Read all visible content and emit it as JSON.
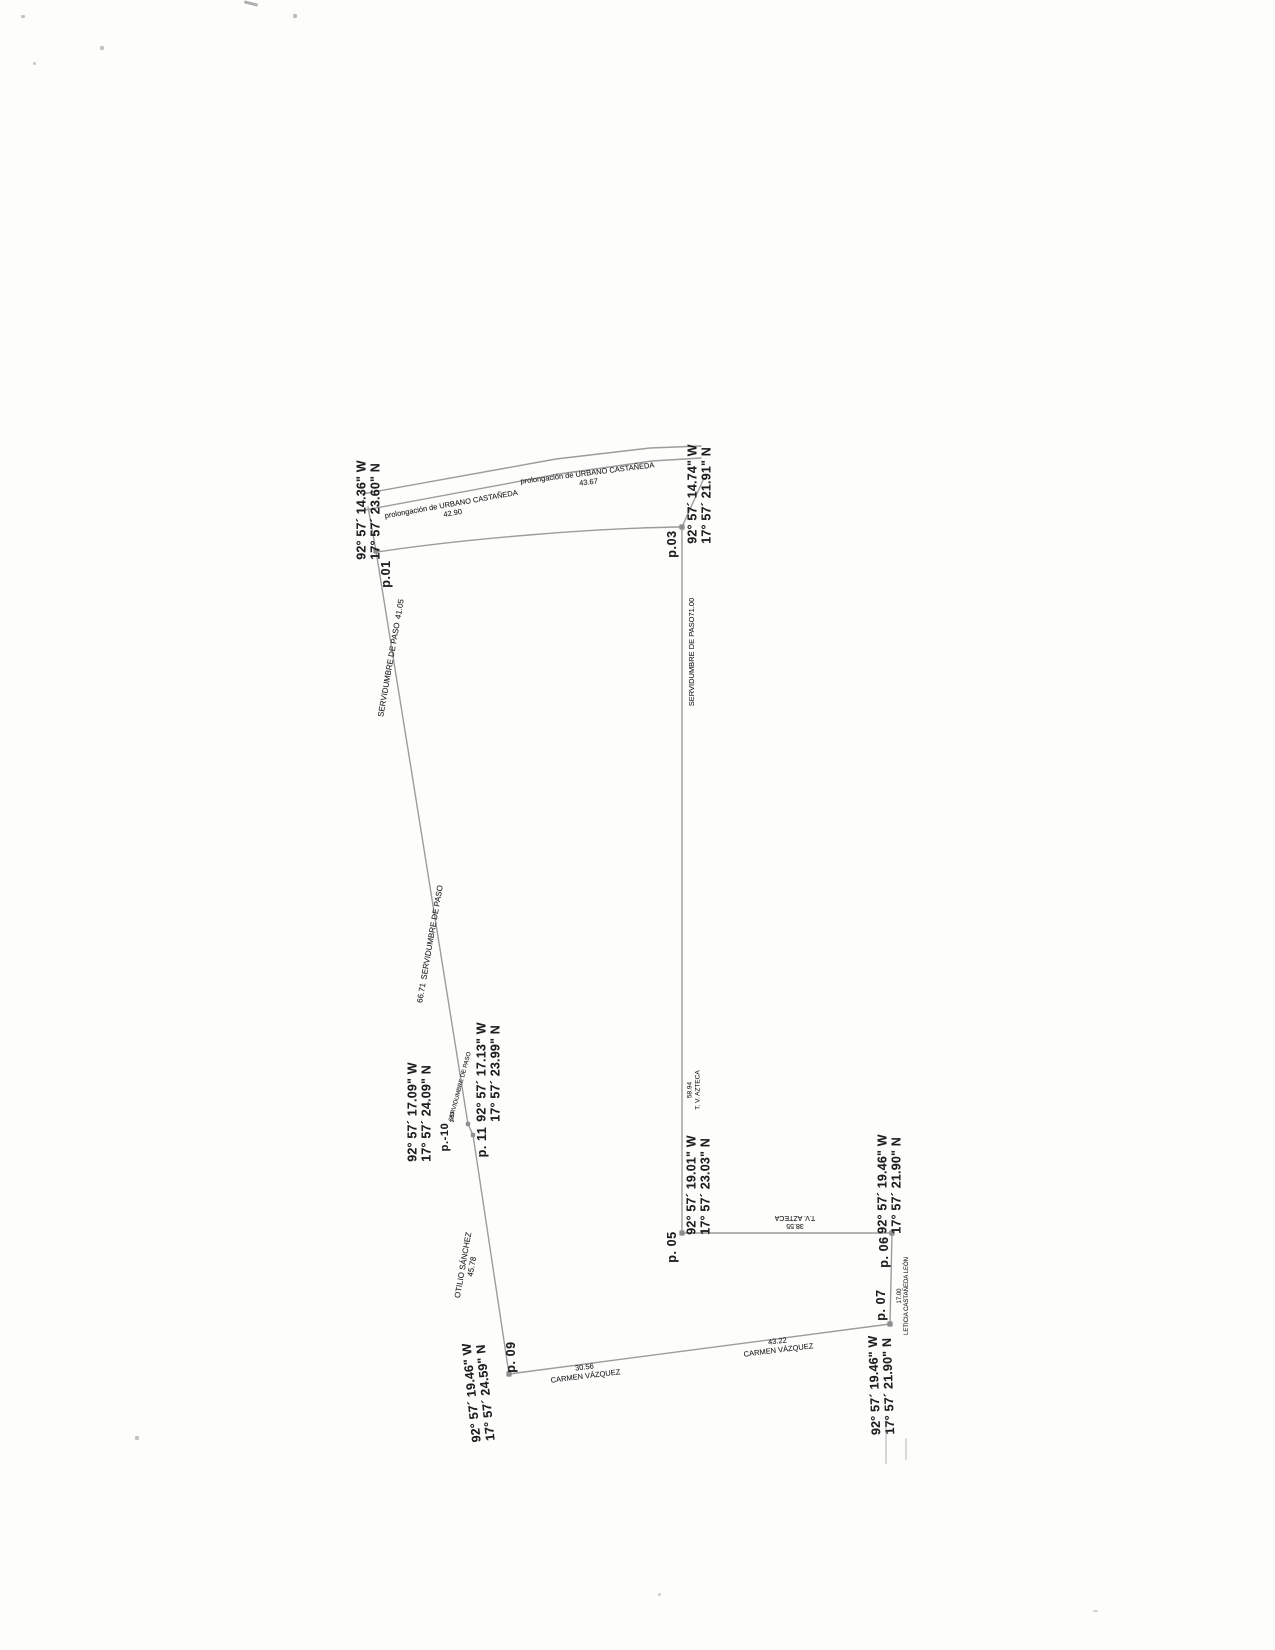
{
  "colors": {
    "paper": "#fdfdfc",
    "boundary_line": "#9c9c9c",
    "text": "#1e1e1e",
    "node": "#8e8e8e"
  },
  "points": {
    "p01": {
      "label": "p.01",
      "w": "92° 57´ 14.36\" W",
      "n": "17° 57´ 23.60\" N"
    },
    "p03": {
      "label": "p.03",
      "w": "92° 57´ 14.74\" W",
      "n": "17° 57´ 21.91\" N"
    },
    "p05": {
      "label": "p. 05",
      "w": "92° 57´ 19.01\" W",
      "n": "17° 57´ 23.03\" N"
    },
    "p06": {
      "label": "p. 06",
      "w": "92° 57´ 19.46\" W",
      "n": "17° 57´ 21.90\" N"
    },
    "p07": {
      "label": "p. 07",
      "w": "92° 57´ 19.46\" W",
      "n": "17° 57´ 21.90\" N"
    },
    "p09": {
      "label": "p. 09",
      "w": "92° 57´ 19.46\" W",
      "n": "17° 57´ 24.59\" N"
    },
    "p10": {
      "label": "p.-10",
      "w": "92° 57´ 17.09\" W",
      "n": "17° 57´ 24.09\" N"
    },
    "p11": {
      "label": "p. 11",
      "w": "92° 57´ 17.13\" W",
      "n": "17° 57´ 23.99\" N"
    }
  },
  "edges": {
    "road_left": {
      "name": "prolongación de URBANO CASTAÑEDA",
      "length": "42.90"
    },
    "road_right": {
      "name": "prolongación de URBANO CASTAÑEDA",
      "length": "43.67"
    },
    "west_upper": {
      "name": "SERVIDUMBRE DE PASO",
      "length": "41.05"
    },
    "west_lower": {
      "length": "66.71",
      "name": "SERVIDUMBRE DE PASO"
    },
    "jog": {
      "length": "2.03",
      "name": "SERVIDUMBRE DE PASO"
    },
    "otilio": {
      "name": "OTILIO SÁNCHEZ",
      "length": "45.78"
    },
    "east_upper": {
      "name": "SERVIDUMBRE DE PASO",
      "length": "71.00"
    },
    "east_lower": {
      "length": "58.94",
      "name": "T. V. AZTECA"
    },
    "azteca": {
      "length": "38.55",
      "name": "T.V. AZTECA"
    },
    "leticia": {
      "length": "17.00",
      "name": "LETICIA CASTAÑEDA LEÓN"
    },
    "carmen_left": {
      "length": "30.56",
      "name": "CARMEN VÁZQUEZ"
    },
    "carmen_right": {
      "length": "43.22",
      "name": "CARMEN VÁZQUEZ"
    }
  }
}
